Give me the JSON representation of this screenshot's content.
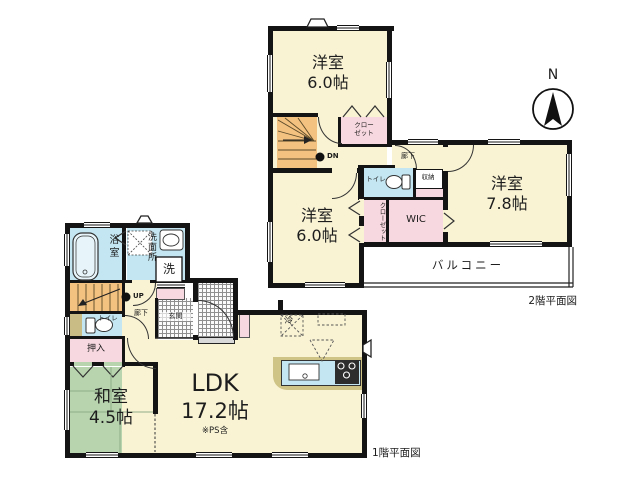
{
  "page": {
    "background": "#ffffff"
  },
  "colors": {
    "wall": "#141414",
    "room_cream": "#F9F3D4",
    "water_blue": "#C3E6F2",
    "closet_pink": "#F8D8E0",
    "tatami_green": "#B7D4AE",
    "stairs_orange": "#F3C180",
    "counter_tan": "#CFC386",
    "balcony_white": "#ffffff"
  },
  "floor2": {
    "title": "2階平面図",
    "compass": "N",
    "rooms": {
      "yoshitsu_top": {
        "name": "洋室",
        "size": "6.0帖"
      },
      "yoshitsu_right": {
        "name": "洋室",
        "size": "7.8帖"
      },
      "yoshitsu_left": {
        "name": "洋室",
        "size": "6.0帖"
      }
    },
    "closet_top": {
      "line1": "クロー",
      "line2": "ゼット"
    },
    "closet_side": "クローゼット",
    "wic": "WIC",
    "toilet": "トイレ",
    "storage": "収納",
    "hallway": "廊下",
    "balcony": "バルコニー",
    "stairs_label": "DN"
  },
  "floor1": {
    "title": "1階平面図",
    "rooms": {
      "washitsu": {
        "name": "和室",
        "size": "4.5帖"
      },
      "ldk": {
        "name": "LDK",
        "size": "17.2帖",
        "note": "※PS含"
      }
    },
    "bath": "浴室",
    "washroom": "洗面所",
    "laundry": "洗",
    "toilet": "トイレ",
    "hallway": "廊下",
    "genkan": "玄関",
    "oshiire": "押入",
    "fridge": "冷",
    "stairs_label": "UP"
  }
}
